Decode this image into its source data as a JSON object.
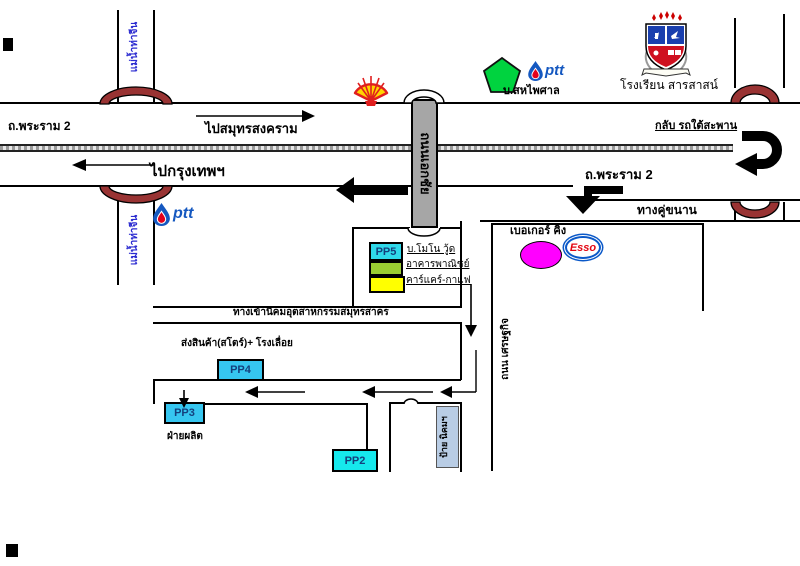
{
  "map": {
    "title": "แผนที่เส้นทาง ถ.พระราม 2 - นิคมอุตสาหกรรมสมุทรสาคร",
    "roads": {
      "rama2": "ถ.พระราม 2",
      "to_samut_songkhram": "ไปสมุทรสงคราม",
      "to_bangkok": "ไปกรุงเทพฯ",
      "u_turn_under_bridge": "กลับ รถใต้สะพาน",
      "frontage_road": "ทางคู่ขนาน",
      "ekachai_road": "ถนนเอกชัย",
      "setthakit_road": "ถนน เศรษฐกิจ",
      "industrial_estate_entrance": "ทางเข้านิคมอุตสาหกรรมสมุทรสาคร"
    },
    "river": {
      "name": "แม่น้ำท่าจีน"
    },
    "landmarks": {
      "saha_phaisan": "บ.สหไพศาล",
      "school": "โรงเรียน สารสาสน์",
      "burger_king": "เบอเกอร์ คิง",
      "mono_wood": "บ.โมโน วู้ด",
      "commercial_building": "อาคารพาณิชย์",
      "car_care_coffee": "คาร์แคร์-กาแฟ",
      "delivery_store_sawmill": "ส่งสินค้า(สโตร์)+ โรงเลื่อย",
      "production_dept": "ฝ่ายผลิต",
      "estate_sign": "ป้าย นิคมฯ",
      "ptt_wordmark": "ptt",
      "esso_wordmark": "Esso"
    },
    "buildings": {
      "pp5": "PP5",
      "pp4": "PP4",
      "pp3": "PP3",
      "pp2": "PP2"
    },
    "colors": {
      "bridge_arch": "#993333",
      "overpass_bar": "#a6a6a6",
      "pp_cyan": "#2fd9ea",
      "green_box": "#9acd32",
      "yellow_box": "#ffff00",
      "magenta_ellipse": "#ff00ff",
      "pentagon_green": "#00d33f",
      "shell_yellow": "#ffd500",
      "shell_red": "#e01f1f",
      "ptt_blue": "#1558c0",
      "esso_blue": "#0a58c8",
      "esso_red": "#e30613",
      "river_text_blue": "#2a2ad0"
    }
  }
}
